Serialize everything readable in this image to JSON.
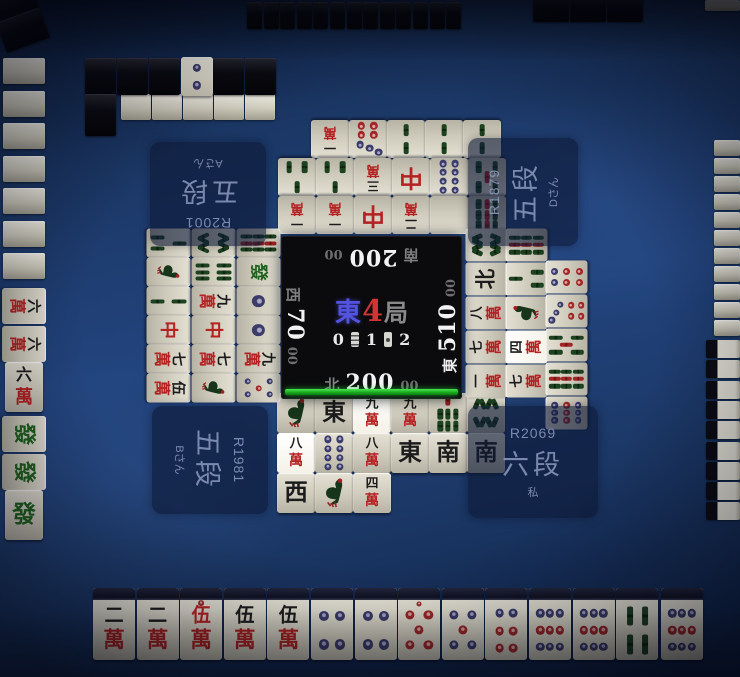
{
  "center": {
    "round_wind": "東",
    "round_number": "4",
    "round_suffix": "局",
    "counter_left": "0",
    "counter_middle": "1",
    "counter_right": "2"
  },
  "players": {
    "self": {
      "position": "bottom",
      "wind": "北",
      "score": "200",
      "score_small": "00",
      "rating": "R2069",
      "rank": "六段",
      "name": "私",
      "dealer": false
    },
    "right": {
      "position": "right",
      "wind": "東",
      "score": "510",
      "score_small": "00",
      "rating": "R1879",
      "rank": "五段",
      "name": "Dさん",
      "dealer": true
    },
    "top": {
      "position": "top",
      "wind": "南",
      "score": "200",
      "score_small": "00",
      "rating": "R2001",
      "rank": "五段",
      "name": "Aさん",
      "dealer": false
    },
    "left": {
      "position": "left",
      "wind": "西",
      "score": "70",
      "score_small": "00",
      "rating": "R1981",
      "rank": "五段",
      "name": "Bさん",
      "dealer": false
    }
  },
  "hand": {
    "tiles": [
      "2m",
      "2m",
      "0m",
      "5m",
      "5m",
      "4p",
      "4p",
      "0p",
      "5p",
      "6p",
      "9p",
      "9p",
      "4s"
    ],
    "drawn": "9p"
  },
  "discards": {
    "top_rows": [
      [
        "1m",
        "7p",
        "2s",
        "2s",
        "2s"
      ],
      [
        "3s",
        "3s",
        "3m",
        "RD",
        "8p",
        "5s"
      ],
      [
        "1m",
        "1m",
        "RD",
        "2m",
        "WH",
        "9s"
      ]
    ],
    "bottom_rows": [
      [
        "1s",
        "E",
        "9m*",
        "9m",
        "7s",
        "8s"
      ],
      [
        "8m*",
        "8p",
        "8m",
        "E",
        "S",
        "S"
      ],
      [
        "W",
        "1s",
        "4m"
      ]
    ],
    "left_cols": [
      [
        "3s",
        "1s",
        "2s",
        "RD",
        "7m",
        "5m"
      ],
      [
        "8s",
        "6s",
        "9m",
        "RD",
        "7m",
        "1s"
      ],
      [
        "9s",
        "GD",
        "1p",
        "1p",
        "9m",
        "5p"
      ]
    ],
    "right_cols": [
      [
        "8s",
        "N",
        "8m",
        "7m",
        "1m"
      ],
      [
        "9s",
        "3s",
        "1s",
        "4m*",
        "7m"
      ],
      [
        "6p",
        "7p",
        "5s",
        "9s",
        "9p"
      ]
    ]
  },
  "melds": {
    "left": [
      [
        "6m",
        "6m",
        "6m&"
      ],
      [
        "GD",
        "GD",
        "GD&"
      ]
    ]
  },
  "dead_wall": {
    "dora_indicator": "2p"
  },
  "colors": {
    "timer_bar": "#21c421",
    "round_wind_blue": "#5353e0",
    "round_number_red": "#d23434",
    "dealer_wind_white": "#ececec",
    "inactive_wind_gray": "#7e7e7e",
    "table_blue": "#22447e"
  }
}
